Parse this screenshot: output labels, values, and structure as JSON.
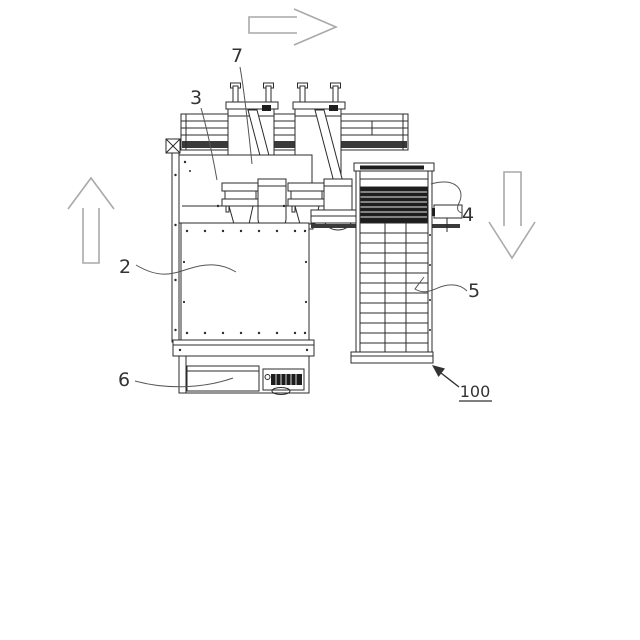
{
  "figure": {
    "kind": "patent-style technical line drawing of a machine",
    "reference_number": "100",
    "background": "#ffffff",
    "colors": {
      "line": "#2b2b2b",
      "label": "#333333",
      "guide_arrow": "#a9a9a9",
      "dark_fill": "#1d1d1d"
    },
    "labels": {
      "l7": "7",
      "l3": "3",
      "l2": "2",
      "l6": "6",
      "l4": "4",
      "l5": "5",
      "l100": "100"
    },
    "direction_arrows": [
      {
        "id": "flow-arrow-right",
        "direction": "right"
      },
      {
        "id": "flow-arrow-up",
        "direction": "up"
      },
      {
        "id": "flow-arrow-down",
        "direction": "down"
      }
    ]
  }
}
